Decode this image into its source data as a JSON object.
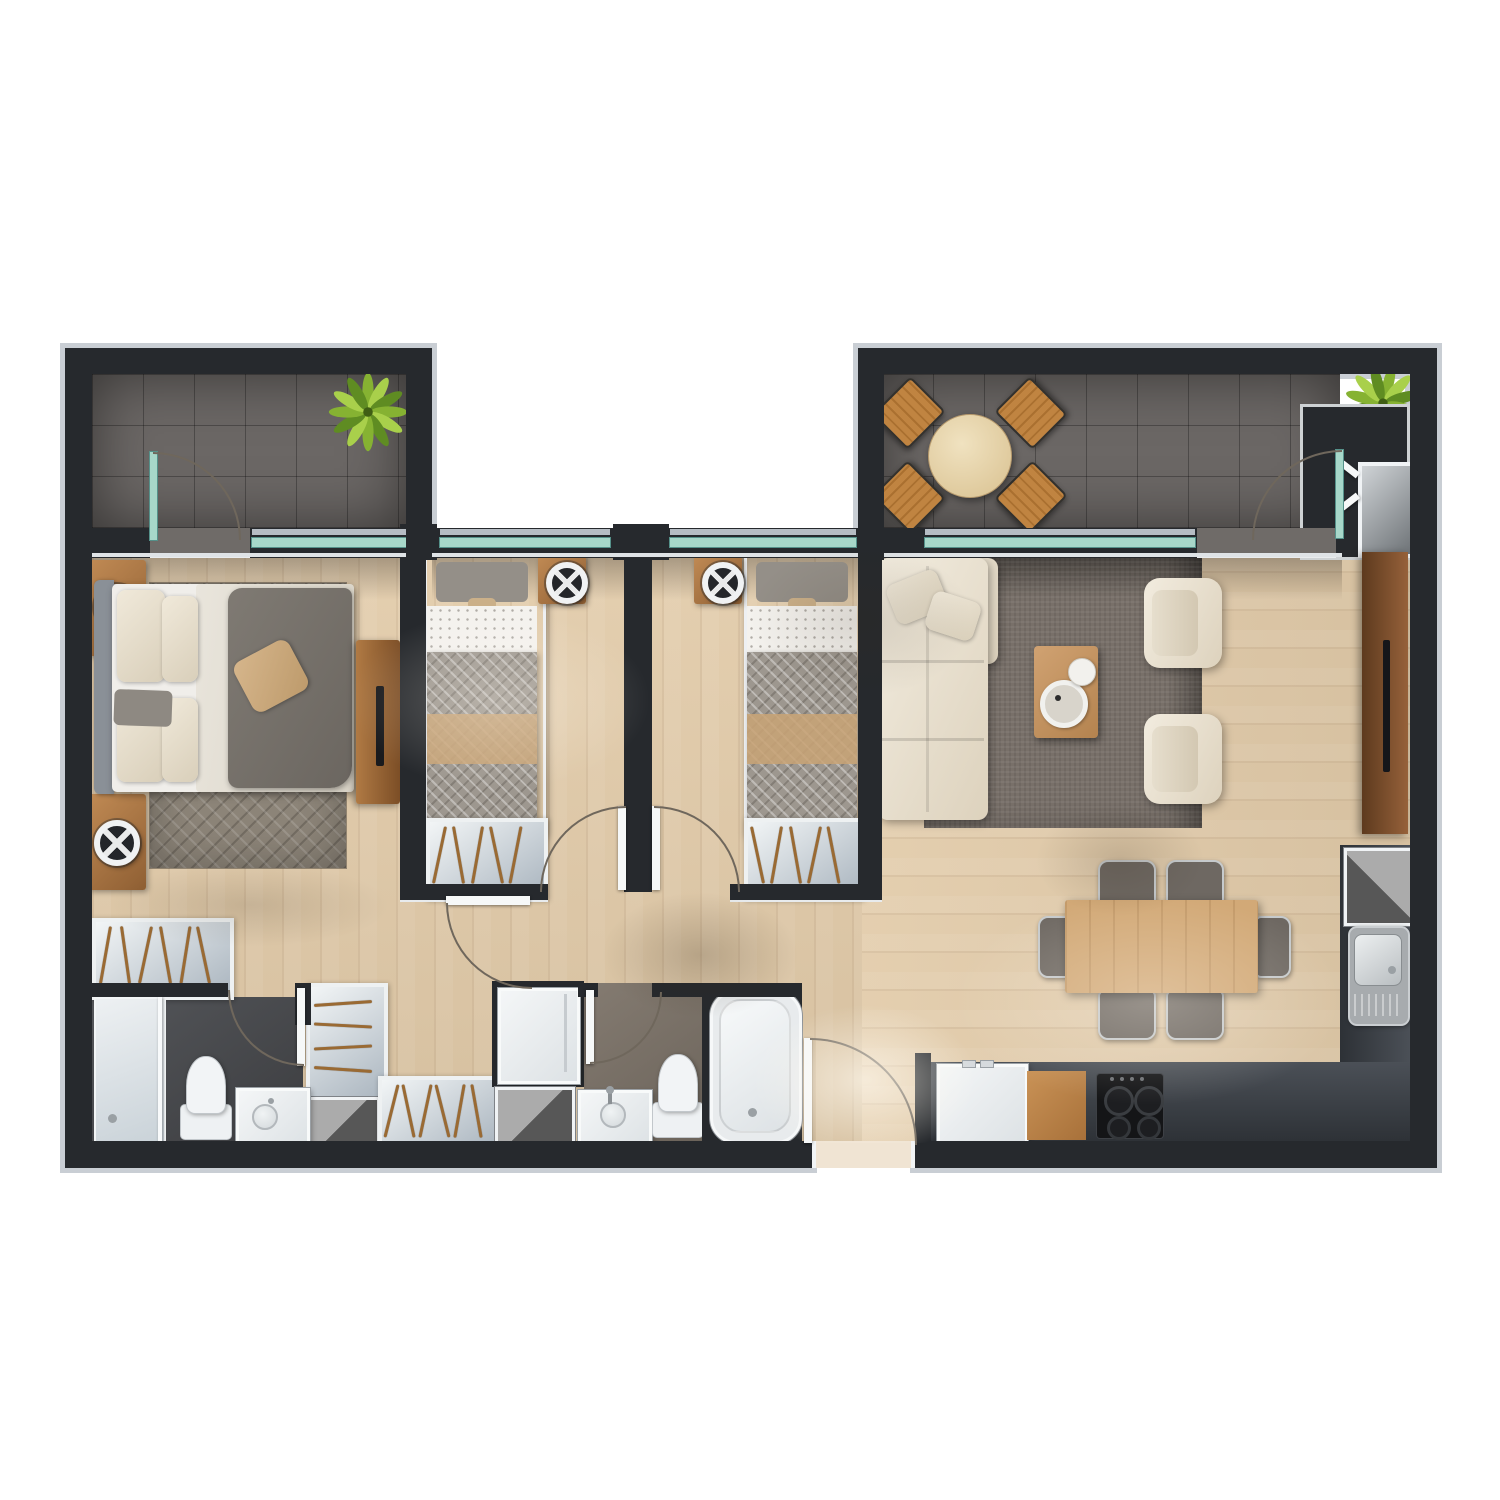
{
  "labels": {
    "stage": "apartment-floor-plan-top-view",
    "balcony_left": "bedroom balcony",
    "balcony_right": "living room terrace",
    "master_bedroom": "master bedroom",
    "bedroom_2": "bedroom 2",
    "bedroom_3": "bedroom 3",
    "hallway": "hallway",
    "bathroom_ensuite": "ensuite bathroom",
    "bathroom_2": "family bathroom",
    "living_room": "living room",
    "dining_area": "dining area",
    "kitchen": "kitchen",
    "entry": "entry",
    "utility_closet": "utility closet"
  },
  "palette": {
    "wall": "#26292d",
    "wallTrim": "#c9ced4",
    "wood": "#e2cba9",
    "woodLight": "#f0e4d3",
    "tile": "#6b6765",
    "glass": "#a7d7c9",
    "glassEdge": "#55918a",
    "cream": "#ece5d5",
    "rugLiving": "#787069",
    "rugMaster": "#8c8478",
    "fabric": "#9d978f",
    "fabricDark": "#76716b",
    "tan": "#c9a376",
    "woodFurn": "#d2a977",
    "woodDark": "#8a5a36",
    "charcoal": "#3a3e44",
    "black": "#17181b",
    "white": "#f2f4f5",
    "metal": "#b9bcbe",
    "shaftLight": "#ababab",
    "shaftDark": "#575757",
    "plantA": "#86b232",
    "plantB": "#a9d04b",
    "plantC": "#5f8c22",
    "arc": "#6f675c"
  },
  "inventory": {
    "balcony_left": {
      "items": [
        "potted-plant",
        "glass-sliding-door",
        "window"
      ],
      "plant_count": 1
    },
    "balcony_right": {
      "items": [
        "round-outdoor-table",
        "outdoor-chair",
        "potted-plant",
        "glass-door",
        "utility-closet-appliance"
      ],
      "chair_count": 4,
      "plant_count": 1
    },
    "master_bedroom": {
      "items": [
        "double-bed",
        "nightstand",
        "table-lamp",
        "area-rug",
        "tv-console",
        "tv",
        "open-wardrobe",
        "linen-closet"
      ],
      "nightstand_count": 2,
      "lamp_count": 2
    },
    "bedroom_2": {
      "items": [
        "single-bed",
        "nightstand",
        "table-lamp",
        "open-wardrobe",
        "window"
      ]
    },
    "bedroom_3": {
      "items": [
        "single-bed",
        "nightstand",
        "table-lamp",
        "open-wardrobe",
        "window"
      ]
    },
    "bathroom_ensuite": {
      "items": [
        "walk-in-shower",
        "toilet",
        "vanity-sink",
        "service-shaft"
      ]
    },
    "bathroom_2": {
      "items": [
        "washing-machine",
        "bathtub",
        "toilet",
        "vanity-sink",
        "service-shaft",
        "hall-wardrobe"
      ]
    },
    "living_room": {
      "items": [
        "sectional-sofa",
        "armchair",
        "coffee-table",
        "area-rug",
        "media-console",
        "tv"
      ],
      "armchair_count": 2
    },
    "dining_area": {
      "items": [
        "dining-table",
        "dining-chair"
      ],
      "chair_count": 6
    },
    "kitchen": {
      "items": [
        "l-shaped-counter",
        "refrigerator",
        "cutting-board",
        "gas-cooktop",
        "kitchen-sink",
        "service-shaft"
      ],
      "burner_count": 4
    },
    "entry": {
      "items": [
        "entry-door"
      ]
    }
  }
}
